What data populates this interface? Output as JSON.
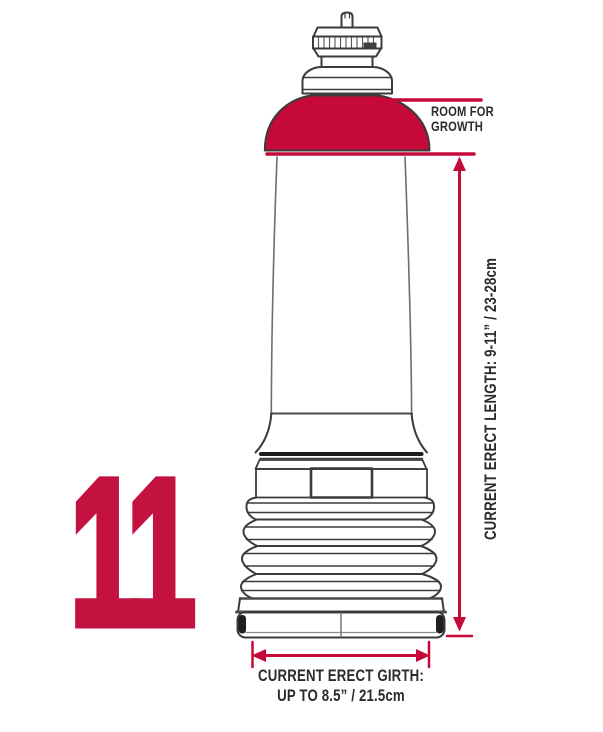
{
  "figure": {
    "number": "11"
  },
  "labels": {
    "room_for_growth_line1": "ROOM FOR",
    "room_for_growth_line2": "GROWTH",
    "length": "CURRENT ERECT LENGTH: 9-11” / 23-28cm",
    "girth_line1": "CURRENT ERECT GIRTH:",
    "girth_line2": "UP TO 8.5” / 21.5cm"
  },
  "colors": {
    "accent_red": "#C50939",
    "numeral_red": "#C31140",
    "line_dark": "#3b3b3b",
    "line_gray": "#6e6e6e",
    "text_dark": "#2b2b2b"
  }
}
